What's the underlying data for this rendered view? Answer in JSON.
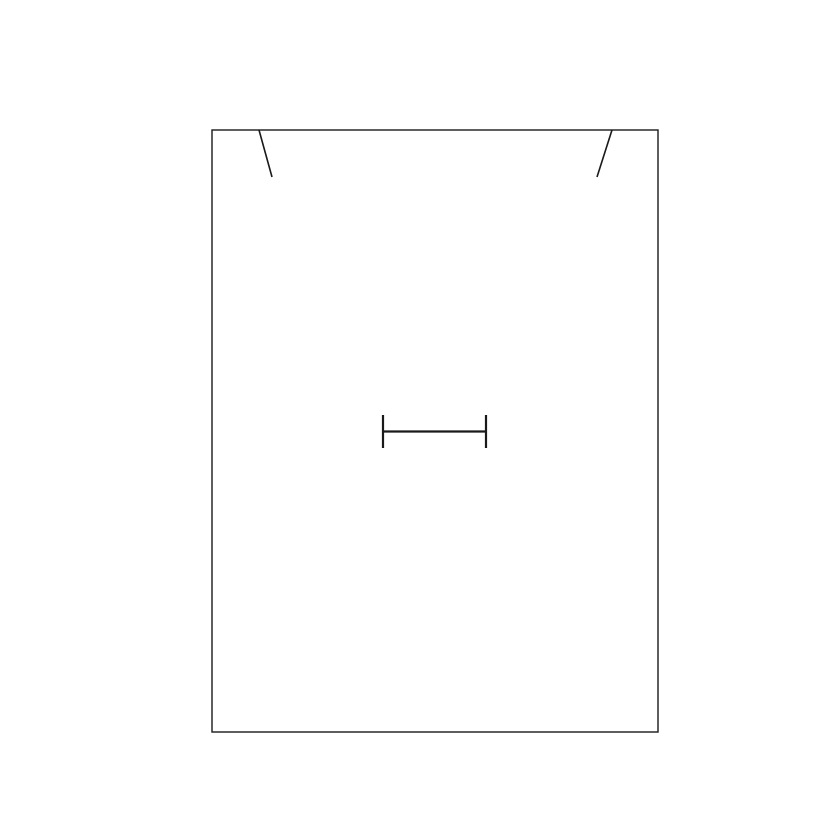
{
  "page": {
    "background_color": "#ffffff"
  },
  "diagram": {
    "description": "pattern-piece line drawing",
    "stroke_color": "#1a1a1a",
    "canvas": {
      "width": 840,
      "height": 840
    },
    "outline_rect": {
      "x": 212,
      "y": 130,
      "width": 446,
      "height": 602,
      "stroke_width": 1.4,
      "fill": "none"
    },
    "notches": [
      {
        "id": "top-left-notch",
        "x1": 259,
        "y1": 130,
        "x2": 272,
        "y2": 177,
        "stroke_width": 1.6
      },
      {
        "id": "top-right-notch",
        "x1": 612,
        "y1": 130,
        "x2": 597,
        "y2": 177,
        "stroke_width": 1.6
      }
    ],
    "center_mark": {
      "id": "buttonhole-mark",
      "bar": {
        "x1": 383,
        "y1": 431.5,
        "x2": 486,
        "y2": 431.5,
        "stroke_width": 2.2
      },
      "caps": [
        {
          "id": "left-cap",
          "x1": 383,
          "y1": 415,
          "x2": 383,
          "y2": 448,
          "stroke_width": 2.2
        },
        {
          "id": "right-cap",
          "x1": 486,
          "y1": 415,
          "x2": 486,
          "y2": 448,
          "stroke_width": 2.2
        }
      ]
    }
  }
}
